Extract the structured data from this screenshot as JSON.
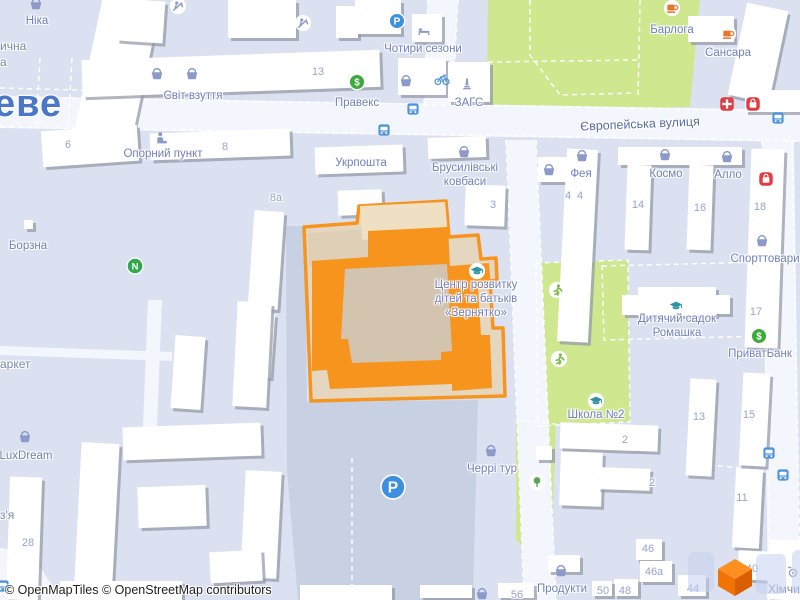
{
  "attribution": "© OpenMapTiles © OpenStreetMap contributors",
  "city_label": {
    "text": "еве",
    "x": -6,
    "y": 104
  },
  "street_labels": [
    {
      "text": "Європейська вулиця",
      "x": 640,
      "y": 124,
      "rotate": -2.5
    }
  ],
  "partial_labels": [
    {
      "text": "ична",
      "x": 0,
      "y": 46
    },
    {
      "text": "а",
      "x": 0,
      "y": 62
    },
    {
      "text": "аркет",
      "x": 0,
      "y": 364
    },
    {
      "text": "з'я",
      "x": 0,
      "y": 515
    },
    {
      "text": "Хімчис",
      "x": 768,
      "y": 589
    }
  ],
  "selected_feature": {
    "name": "Центр розвитку дітей та батьків «Зернятко»",
    "label_lines": [
      "Центр розвитку",
      "дітей та батьків",
      "«Зернятко»"
    ],
    "label_x": 476,
    "label_y": 299,
    "fill": "#F7941E",
    "courtyard": "#D2C4AF",
    "outline": "#F7941E"
  },
  "pois": [
    {
      "text": "Ніка",
      "x": 37,
      "y": 21
    },
    {
      "text": "Світ взуття",
      "x": 193,
      "y": 96
    },
    {
      "text": "Правекс",
      "x": 357,
      "y": 103
    },
    {
      "text": "Чотири сезони",
      "x": 423,
      "y": 49
    },
    {
      "text": "ЗАГС",
      "x": 469,
      "y": 103
    },
    {
      "text": "Барлога",
      "x": 672,
      "y": 30
    },
    {
      "text": "Сансара",
      "x": 728,
      "y": 53
    },
    {
      "text": "Укрпошта",
      "x": 361,
      "y": 163
    },
    {
      "lines": [
        "Брусилівські",
        "ковбаси"
      ],
      "x": 465,
      "y": 175
    },
    {
      "text": "Опорний пункт",
      "x": 163,
      "y": 154
    },
    {
      "text": "Борзна",
      "x": 28,
      "y": 246
    },
    {
      "text": "LuxDream",
      "x": 26,
      "y": 456
    },
    {
      "text": "Фея",
      "x": 581,
      "y": 174
    },
    {
      "text": "Космо",
      "x": 666,
      "y": 174
    },
    {
      "text": "Алло",
      "x": 728,
      "y": 175
    },
    {
      "text": "Спорттовари",
      "x": 765,
      "y": 259
    },
    {
      "lines": [
        "Дитячий садок",
        "Ромашка"
      ],
      "x": 677,
      "y": 326
    },
    {
      "text": "ПриватБанк",
      "x": 760,
      "y": 354
    },
    {
      "text": "Школа №2",
      "x": 596,
      "y": 415
    },
    {
      "text": "Черрі тур",
      "x": 492,
      "y": 469
    },
    {
      "text": "Продукти",
      "x": 562,
      "y": 589
    }
  ],
  "markers": [
    {
      "type": "basket",
      "x": 36,
      "y": 4
    },
    {
      "type": "basket",
      "x": 157,
      "y": 74
    },
    {
      "type": "basket",
      "x": 192,
      "y": 74
    },
    {
      "type": "basket",
      "x": 406,
      "y": 81
    },
    {
      "type": "basket",
      "x": 464,
      "y": 152
    },
    {
      "type": "basket",
      "x": 549,
      "y": 170
    },
    {
      "type": "basket",
      "x": 582,
      "y": 156
    },
    {
      "type": "basket",
      "x": 665,
      "y": 155
    },
    {
      "type": "basket",
      "x": 727,
      "y": 157
    },
    {
      "type": "basket",
      "x": 762,
      "y": 241
    },
    {
      "type": "basket",
      "x": 491,
      "y": 451
    },
    {
      "type": "basket",
      "x": 561,
      "y": 571
    },
    {
      "type": "basket",
      "x": 482,
      "y": 594
    },
    {
      "type": "basket",
      "x": 25,
      "y": 437
    },
    {
      "type": "money",
      "x": 357,
      "y": 82
    },
    {
      "type": "money",
      "x": 759,
      "y": 336
    },
    {
      "type": "parking",
      "x": 397,
      "y": 21
    },
    {
      "type": "parking_big",
      "x": 393,
      "y": 487
    },
    {
      "type": "bed",
      "x": 424,
      "y": 30
    },
    {
      "type": "bicycle",
      "x": 442,
      "y": 79
    },
    {
      "type": "monument",
      "x": 467,
      "y": 84
    },
    {
      "type": "coffee",
      "x": 672,
      "y": 8
    },
    {
      "type": "coffee",
      "x": 728,
      "y": 34
    },
    {
      "type": "pharmacy",
      "x": 727,
      "y": 104
    },
    {
      "type": "shopred",
      "x": 753,
      "y": 104
    },
    {
      "type": "shopred",
      "x": 766,
      "y": 179
    },
    {
      "type": "bus",
      "x": 413,
      "y": 109
    },
    {
      "type": "bus",
      "x": 384,
      "y": 130
    },
    {
      "type": "bus",
      "x": 778,
      "y": 118
    },
    {
      "type": "bus",
      "x": 769,
      "y": 453
    },
    {
      "type": "bus",
      "x": 783,
      "y": 475
    },
    {
      "type": "bus",
      "x": 3,
      "y": 586
    },
    {
      "type": "education",
      "x": 477,
      "y": 271
    },
    {
      "type": "education",
      "x": 676,
      "y": 306
    },
    {
      "type": "education",
      "x": 596,
      "y": 401
    },
    {
      "type": "running",
      "x": 557,
      "y": 290
    },
    {
      "type": "running",
      "x": 559,
      "y": 359
    },
    {
      "type": "tree",
      "x": 537,
      "y": 482
    },
    {
      "type": "playground",
      "x": 178,
      "y": 6
    },
    {
      "type": "playground",
      "x": 303,
      "y": 23
    },
    {
      "type": "workplace",
      "x": 162,
      "y": 138
    },
    {
      "type": "novus",
      "x": 135,
      "y": 266
    },
    {
      "type": "washer",
      "x": 793,
      "y": 572
    }
  ],
  "house_numbers": [
    {
      "text": "13",
      "x": 318,
      "y": 72
    },
    {
      "text": "6",
      "x": 68,
      "y": 145
    },
    {
      "text": "8",
      "x": 225,
      "y": 147
    },
    {
      "text": "8а",
      "x": 276,
      "y": 198
    },
    {
      "text": "3",
      "x": 493,
      "y": 205
    },
    {
      "text": "4",
      "x": 568,
      "y": 196
    },
    {
      "text": "4",
      "x": 580,
      "y": 196
    },
    {
      "text": "14",
      "x": 638,
      "y": 205
    },
    {
      "text": "16",
      "x": 700,
      "y": 208
    },
    {
      "text": "18",
      "x": 760,
      "y": 207
    },
    {
      "text": "17",
      "x": 756,
      "y": 312
    },
    {
      "text": "13",
      "x": 699,
      "y": 417
    },
    {
      "text": "15",
      "x": 749,
      "y": 415
    },
    {
      "text": "2",
      "x": 625,
      "y": 440
    },
    {
      "text": "2",
      "x": 652,
      "y": 483
    },
    {
      "text": "11",
      "x": 742,
      "y": 498
    },
    {
      "text": "46",
      "x": 648,
      "y": 549
    },
    {
      "text": "46а",
      "x": 654,
      "y": 572
    },
    {
      "text": "40",
      "x": 752,
      "y": 569
    },
    {
      "text": "44",
      "x": 693,
      "y": 589
    },
    {
      "text": "48",
      "x": 625,
      "y": 591
    },
    {
      "text": "50",
      "x": 603,
      "y": 591
    },
    {
      "text": "56",
      "x": 517,
      "y": 595
    },
    {
      "text": "28",
      "x": 28,
      "y": 543
    }
  ],
  "colors": {
    "background": "#dbe1f0",
    "road": "#f3f6fc",
    "park": "#cfe890",
    "parking_area": "#c8d0e4",
    "building": "#ffffff",
    "building_shadow": "#9499a8",
    "poi_label": "#7280bc",
    "street_label": "#5a6ca3",
    "number_label": "#96a4cd",
    "city_label": "#4b77c9",
    "selected_orange": "#f7941e",
    "money_green": "#3baa39",
    "parking_blue": "#3d8fe0",
    "bus_blue": "#4d94db",
    "red_poi": "#e03c41",
    "coffee_orange": "#e8752b",
    "education_teal": "#2f93a3",
    "sport_green": "#7cb94a",
    "basket_lavender": "#8c9ac9"
  },
  "geometry": {
    "parks": [
      "M488 0 L700 0 L690 107 L487 113 Z",
      "M536 263 L628 260 L630 422 L538 426 Z",
      "M516 420 L556 424 L552 530 L540 562 L516 540 Z"
    ],
    "parking_areas": [
      "M286 226 L305 226 L307 402 L478 400 L473 600 L298 600 L287 470 Z"
    ],
    "roads": [
      "M0 96 L800 110 L800 142 L0 128 Z",
      "M428 0 L458 0 L452 110 L424 108 Z",
      "M506 140 L536 140 L556 600 L524 600 Z",
      "M762 140 L794 140 L800 600 L768 600 Z",
      "M148 300 L162 300 L156 452 L142 452 Z",
      "M0 346 L172 352 L172 361 L0 355 Z",
      "M0 548 L30 552 L62 600 L0 600 Z"
    ],
    "dashes": [
      "M0 97 L800 111",
      "M0 127 L800 141",
      "M428 0 L424 108",
      "M458 0 L452 108",
      "M506 140 L524 600",
      "M536 140 L556 600",
      "M762 140 L770 600",
      "M792 140 L800 560",
      "M530 0 L530 55 L560 95 L635 93",
      "M488 62 L638 60",
      "M640 0 L638 98",
      "M536 263 L628 260 L630 422 L538 426 Z",
      "M602 266 L764 262 L766 336 L604 340 Z",
      "M700 464 L764 470",
      "M352 458 L352 600",
      "M40 58 L36 130",
      "M72 58 L68 130",
      "M0 88 L230 94",
      "M516 420 L556 424"
    ],
    "buildings": [
      [
        88,
        0,
        58,
        140,
        12
      ],
      [
        118,
        0,
        46,
        42,
        4
      ],
      [
        82,
        55,
        298,
        37,
        -2
      ],
      [
        228,
        0,
        68,
        38,
        0
      ],
      [
        336,
        6,
        22,
        32,
        0
      ],
      [
        355,
        0,
        46,
        34,
        0
      ],
      [
        412,
        14,
        30,
        28,
        0
      ],
      [
        398,
        58,
        48,
        37,
        0
      ],
      [
        448,
        62,
        42,
        40,
        0
      ],
      [
        688,
        16,
        46,
        26,
        0
      ],
      [
        737,
        6,
        42,
        94,
        12
      ],
      [
        745,
        90,
        55,
        22,
        0
      ],
      [
        42,
        128,
        96,
        36,
        -4
      ],
      [
        150,
        131,
        140,
        27,
        -2
      ],
      [
        251,
        211,
        30,
        98,
        4
      ],
      [
        243,
        313,
        30,
        64,
        4
      ],
      [
        315,
        146,
        88,
        27,
        -2
      ],
      [
        338,
        190,
        44,
        25,
        -2
      ],
      [
        428,
        137,
        58,
        21,
        -2
      ],
      [
        465,
        185,
        40,
        41,
        2
      ],
      [
        538,
        157,
        32,
        25,
        0
      ],
      [
        562,
        149,
        31,
        193,
        3
      ],
      [
        618,
        147,
        124,
        18,
        0
      ],
      [
        626,
        165,
        24,
        85,
        2
      ],
      [
        688,
        165,
        24,
        85,
        2
      ],
      [
        748,
        149,
        33,
        199,
        2
      ],
      [
        622,
        295,
        18,
        20,
        0
      ],
      [
        638,
        287,
        78,
        29,
        0
      ],
      [
        714,
        295,
        16,
        19,
        0
      ],
      [
        560,
        424,
        98,
        26,
        2
      ],
      [
        560,
        452,
        42,
        54,
        2
      ],
      [
        598,
        468,
        52,
        22,
        2
      ],
      [
        536,
        446,
        16,
        14,
        0
      ],
      [
        688,
        379,
        26,
        97,
        3
      ],
      [
        741,
        373,
        27,
        93,
        3
      ],
      [
        734,
        469,
        27,
        79,
        3
      ],
      [
        173,
        336,
        30,
        73,
        4
      ],
      [
        235,
        302,
        34,
        105,
        3
      ],
      [
        123,
        425,
        138,
        33,
        -2
      ],
      [
        78,
        443,
        38,
        139,
        3
      ],
      [
        138,
        486,
        68,
        41,
        -2
      ],
      [
        243,
        471,
        36,
        107,
        3
      ],
      [
        210,
        551,
        52,
        31,
        -3
      ],
      [
        8,
        477,
        32,
        123,
        2
      ],
      [
        60,
        581,
        122,
        19,
        0
      ],
      [
        300,
        585,
        92,
        15,
        0
      ],
      [
        636,
        539,
        26,
        21,
        0
      ],
      [
        640,
        561,
        32,
        21,
        0
      ],
      [
        738,
        551,
        36,
        29,
        3
      ],
      [
        678,
        575,
        28,
        21,
        0
      ],
      [
        614,
        579,
        24,
        17,
        0
      ],
      [
        592,
        581,
        20,
        15,
        0
      ],
      [
        498,
        583,
        36,
        15,
        0
      ],
      [
        420,
        585,
        52,
        13,
        0
      ],
      [
        548,
        555,
        32,
        17,
        0
      ],
      [
        768,
        540,
        34,
        60,
        2
      ],
      [
        24,
        220,
        9,
        9,
        0
      ]
    ],
    "selected_paths": {
      "outer": "M304 227 L357 223 L359 206 L446 201 L449 237 L478 235 L481 259 L496 258 L497 280 L490 281 L493 328 L503 328 L505 396 L311 401 Z",
      "under_tan": "M308 233 L368 229 L369 263 L309 266 Z",
      "extension": "M360 206 L445 202 L448 236 L362 240 Z",
      "ring": "M312 261 L368 257 L368 231 L448 227 L450 266 L489 263 L491 287 L478 288 L481 335 L490 335 L492 388 L452 391 L452 384 L330 389 L327 370 L312 371 Z",
      "courtyard": "M345 269 L447 264 L452 351 L441 352 L441 360 L352 363 L348 339 L341 339 Z"
    }
  }
}
